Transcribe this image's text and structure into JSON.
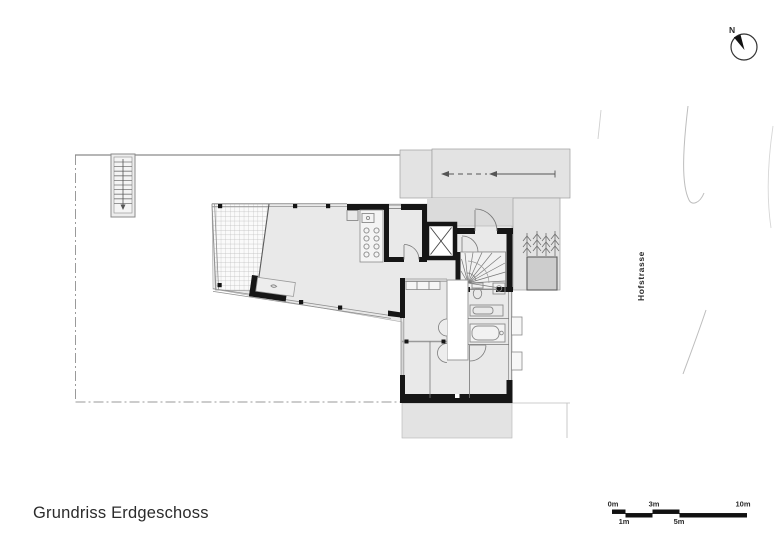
{
  "title": "Grundriss Erdgeschoss",
  "street": {
    "label": "Hofstrasse"
  },
  "north_indicator": {
    "label": "N"
  },
  "scale_bar": {
    "labels": [
      "0m",
      "1m",
      "3m",
      "5m",
      "10m"
    ]
  },
  "colors": {
    "wall": "#161616",
    "interior": "#e9e9e9",
    "paving": "#e3e3e3",
    "porch": "#dbdbdb",
    "planter": "#cdcdcd",
    "boundary_line": "#8f8f8f",
    "street_line": "#bdbdbd",
    "text": "#2b2b2b"
  },
  "icons": {
    "north_arrow": "north-arrow-icon",
    "trees": "tree-icon",
    "spiral_stair": "spiral-stair-icon",
    "elevator": "elevator-x-icon",
    "external_stair": "straight-stair-icon"
  }
}
